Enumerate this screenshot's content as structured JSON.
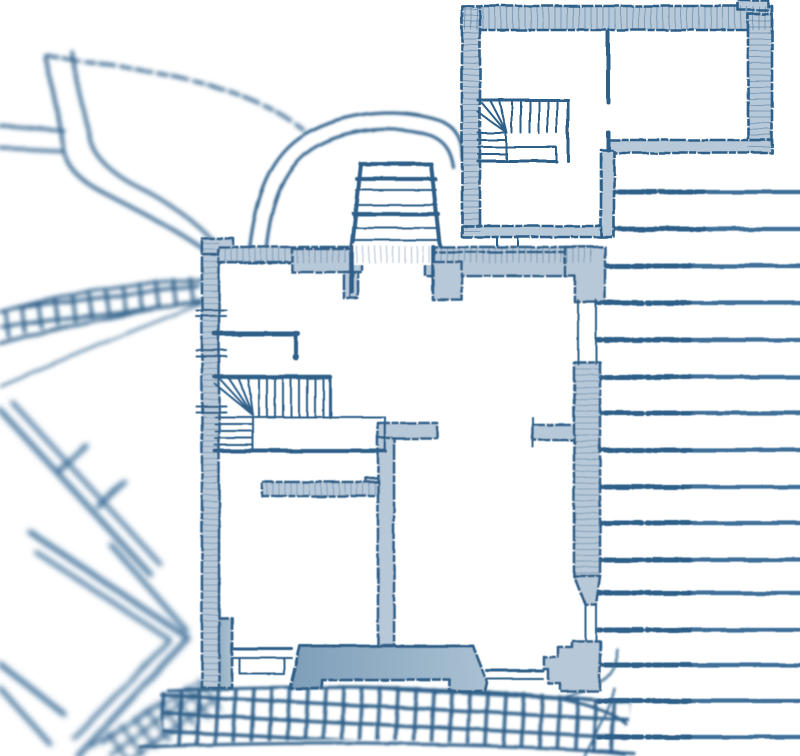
{
  "colors": {
    "ink": "#2d5e88",
    "ink-soft": "#3f6f99",
    "wall-light": "#b7c9d9",
    "wall-med-dark": "#7e9eb9",
    "wall-med-light": "#aac1d2",
    "paper": "#ffffff"
  },
  "terrace_steps": {
    "y_values": [
      192,
      229,
      266,
      303,
      340,
      377,
      413,
      450,
      487,
      523,
      560,
      593,
      630,
      665,
      701,
      737
    ],
    "x_right": 800,
    "x_left_upper": 612,
    "x_left_lower": 598,
    "upper_threshold_y": 260
  }
}
